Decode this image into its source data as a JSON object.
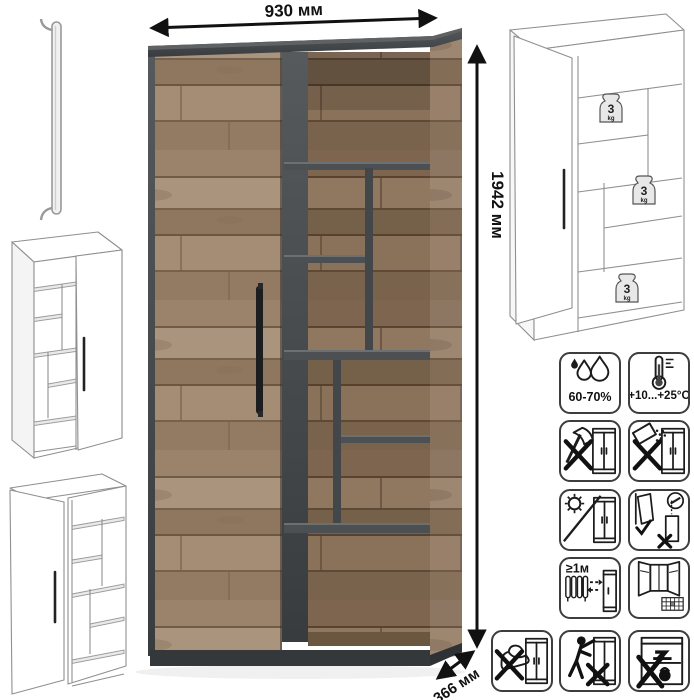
{
  "colors": {
    "wood": "#a18a73",
    "wood_interior": "#856e57",
    "graphite": "#45494b",
    "handle_black": "#1b1d1f",
    "sketch_stroke": "#8f8f8f",
    "icon_stroke": "#1c1c1c"
  },
  "dimensions": {
    "width_label": "930 мм",
    "height_label": "1942 мм",
    "depth_label": "366 мм"
  },
  "internal_drawing": {
    "weights": [
      {
        "value": "3",
        "unit": "kg"
      },
      {
        "value": "3",
        "unit": "kg"
      },
      {
        "value": "3",
        "unit": "kg"
      }
    ]
  },
  "care_icons": {
    "items": [
      {
        "name": "humidity-icon",
        "caption": "60-70%"
      },
      {
        "name": "temperature-icon",
        "caption": "+10...+25°C"
      },
      {
        "name": "no-sharp-objects-icon",
        "caption": ""
      },
      {
        "name": "no-spills-icon",
        "caption": ""
      },
      {
        "name": "no-direct-sunlight-icon",
        "caption": ""
      },
      {
        "name": "anchor-to-wall-icon",
        "caption": ""
      },
      {
        "name": "heat-distance-icon",
        "caption": "≥1м"
      },
      {
        "name": "ventilation-icon",
        "caption": ""
      },
      {
        "name": "no-impact-icon",
        "caption": ""
      },
      {
        "name": "no-climbing-icon",
        "caption": ""
      },
      {
        "name": "no-overload-icon",
        "caption": ""
      }
    ]
  }
}
